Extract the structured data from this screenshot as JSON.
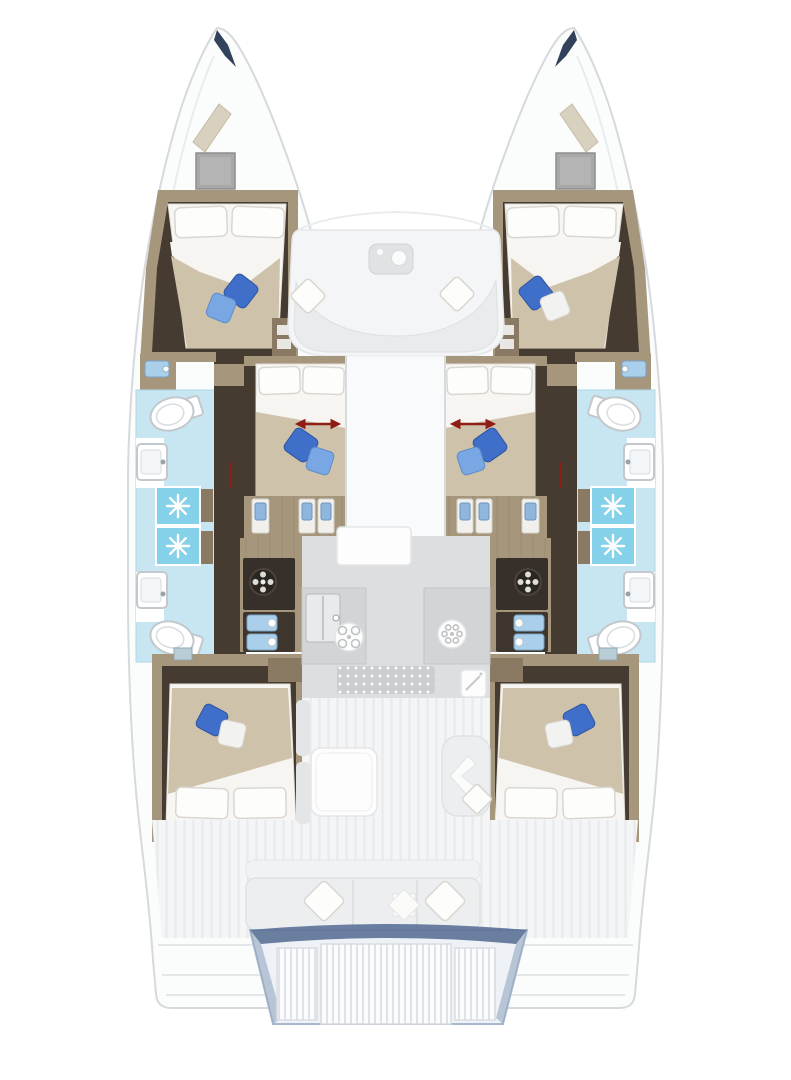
{
  "plan": {
    "vessel": "catamaran-floor-plan",
    "hulls": [
      "port",
      "starboard"
    ],
    "counts": {
      "cabins": 6,
      "double-berths": 6,
      "bathrooms": 4,
      "shower-stalls": 4
    },
    "areas": [
      "bow-locker-port",
      "bow-locker-starboard",
      "forward-cabin-port",
      "forward-cabin-starboard",
      "mid-cabin-port",
      "mid-cabin-starboard",
      "aft-cabin-port",
      "aft-cabin-starboard",
      "bathroom-forward-port",
      "bathroom-aft-port",
      "bathroom-forward-starboard",
      "bathroom-aft-starboard",
      "shower-stalls-port",
      "shower-stalls-starboard",
      "forward-cockpit",
      "galley",
      "salon",
      "aft-cockpit",
      "swim-platform",
      "transom-steps"
    ],
    "icons": [
      "toilet-icon",
      "washbasin-icon",
      "shower-jet-icon",
      "vanity-sink-icon",
      "cooktop-burner-icon",
      "extractor-fan-icon",
      "galley-sink-icon",
      "fridge-icon",
      "dining-table-icon",
      "coffee-table-icon",
      "bed-icon",
      "pillow-icon",
      "throw-pillow-icon",
      "wardrobe-icon",
      "bench-seat-icon",
      "chevron-cushion-icon",
      "diamond-cushion-icon",
      "bow-hatch-icon",
      "skylight-icon",
      "sliding-berth-arrow-icon"
    ]
  },
  "colors": {
    "hull_fill": "#fbfcfc",
    "hull_stroke": "#d6dadd",
    "bow_tip": "#32415c",
    "wood": "#a6967c",
    "wood_dark": "#8a7a64",
    "floor_dark": "#463b30",
    "duvet_tan": "#cfc2aa",
    "linen_white": "#f7f6f2",
    "pillow_dark_blue": "#3f6fc9",
    "pillow_light_blue": "#79a7e4",
    "bath_floor": "#c7e6f2",
    "shower_blue": "#85d1e9",
    "mini_sink_blue": "#a9cfeb",
    "counter_gray": "#d2d4d6",
    "appliance_dark": "#37302a",
    "galley_floor": "#dcdedf",
    "deck_gray": "#f4f5f6",
    "arrow_red": "#8e1d15",
    "platform_edge": "#5b7197"
  }
}
